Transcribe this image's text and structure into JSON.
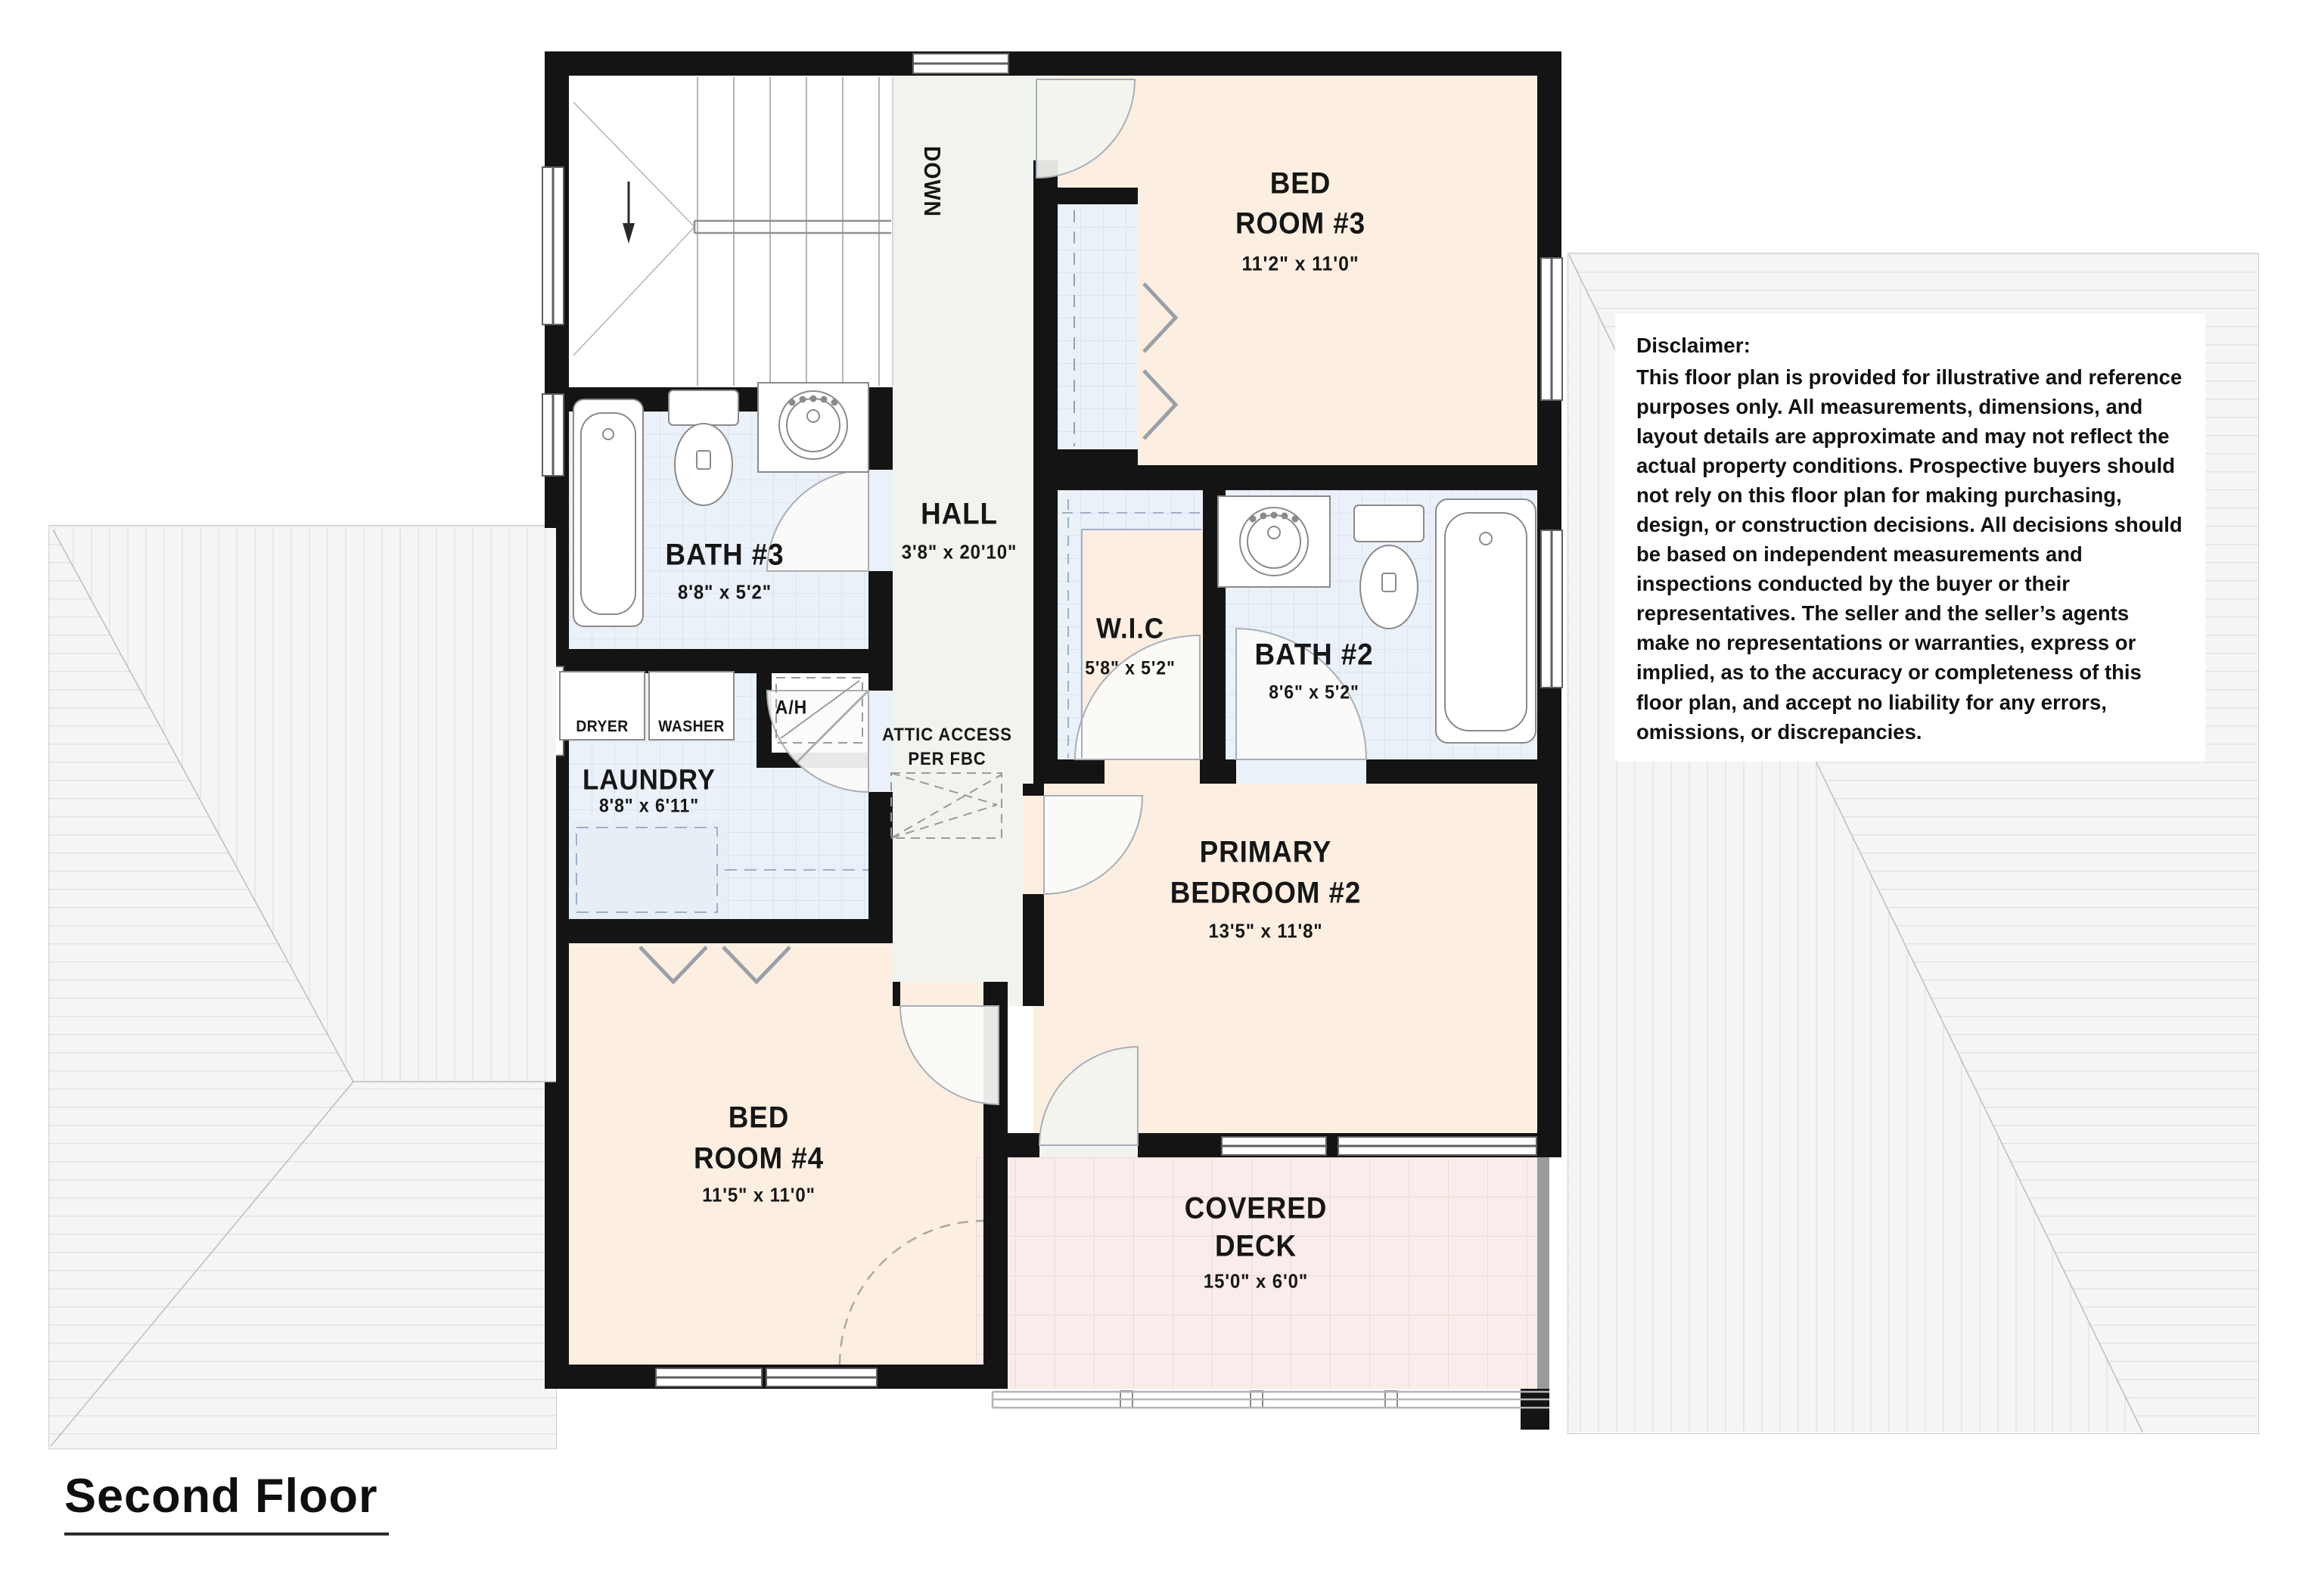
{
  "floor_title": "Second Floor",
  "disclaimer": {
    "title": "Disclaimer:",
    "body": "This floor plan is provided for illustrative and reference purposes only. All measurements, dimensions, and layout details are approximate and may not reflect the actual property conditions. Prospective buyers should not rely on this floor plan for making purchasing, design, or construction decisions. All decisions should be based on independent measurements and inspections conducted by the buyer or their representatives. The seller and the seller’s agents make no representations or warranties, express or implied, as to the accuracy or completeness of this floor plan, and accept no liability for any errors, omissions, or discrepancies."
  },
  "rooms": {
    "bed3": {
      "name1": "BED",
      "name2": "ROOM #3",
      "dims": "11'2\" x 11'0\""
    },
    "bath3": {
      "name": "BATH #3",
      "dims": "8'8\" x 5'2\""
    },
    "hall": {
      "name": "HALL",
      "dims": "3'8\" x 20'10\""
    },
    "wic": {
      "name": "W.I.C",
      "dims": "5'8\" x 5'2\""
    },
    "bath2": {
      "name": "BATH #2",
      "dims": "8'6\" x 5'2\""
    },
    "laundry": {
      "name": "LAUNDRY",
      "dims": "8'8\" x 6'11\""
    },
    "primary": {
      "name1": "PRIMARY",
      "name2": "BEDROOM #2",
      "dims": "13'5\" x 11'8\""
    },
    "bed4": {
      "name1": "BED",
      "name2": "ROOM #4",
      "dims": "11'5\" x 11'0\""
    },
    "deck": {
      "name1": "COVERED",
      "name2": "DECK",
      "dims": "15'0\" x 6'0\""
    }
  },
  "annotations": {
    "down": "DOWN",
    "attic_line1": "ATTIC ACCESS",
    "attic_line2": "PER FBC",
    "ah": "A/H",
    "dryer": "DRYER",
    "washer": "WASHER"
  },
  "colors": {
    "wall": "#141414",
    "bedroom_fill": "#fcefe2",
    "wet_room_fill": "#ebf1f8",
    "hall_fill": "#f1f3ee",
    "deck_fill": "#f9ecea",
    "roof_fill": "#f5f5f5"
  }
}
